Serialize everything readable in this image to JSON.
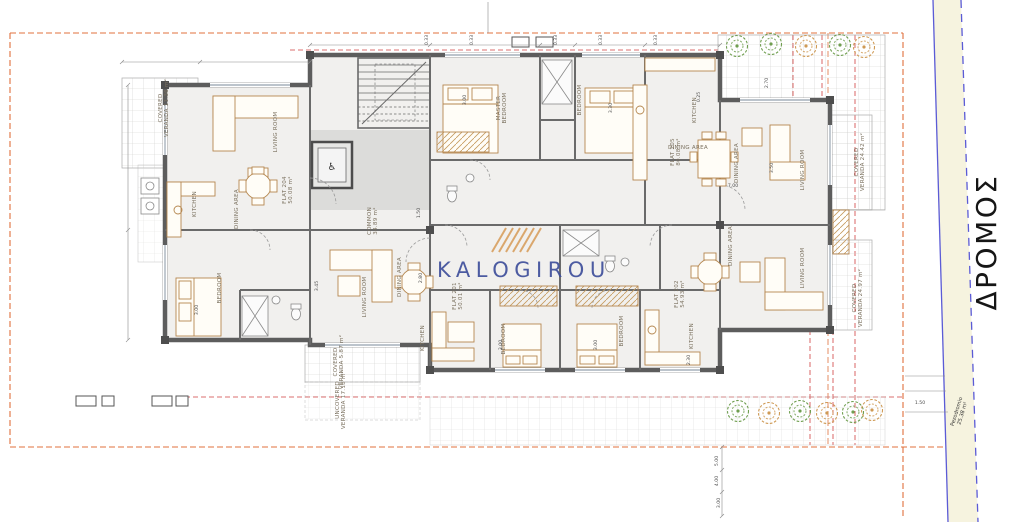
{
  "plan": {
    "watermark": {
      "text": "KALOGIROU"
    },
    "road": {
      "name": "ΔΡΟΜΟΣ",
      "sidewalk_name": "Pezodromio",
      "sidewalk_area": "25.38 m²"
    },
    "icons": {
      "wheelchair": "♿"
    },
    "colors": {
      "watermark": "#3f4f9b",
      "road_line": "#5b5bd6",
      "road_fill": "#f6f3df",
      "boundary": "#e0703d",
      "setback": "#cf4040",
      "wall": "#5d5d5d",
      "furniture": "#b5874f",
      "tree_green": "#6f9e4f",
      "tree_tan": "#cf9a55"
    },
    "room_labels": [
      {
        "text": "COVERED",
        "area": "VERANDA 11.36 m²",
        "x": 162,
        "y": 108,
        "rot": -90
      },
      {
        "text": "LIVING ROOM",
        "x": 277,
        "y": 132,
        "rot": -90
      },
      {
        "text": "KITCHEN",
        "x": 196,
        "y": 204,
        "rot": -90
      },
      {
        "text": "DINING AREA",
        "x": 238,
        "y": 209,
        "rot": -90
      },
      {
        "text": "FLAT 204",
        "area": "50.08 m²",
        "x": 286,
        "y": 190,
        "rot": -90
      },
      {
        "text": "BEDROOM",
        "x": 221,
        "y": 288,
        "rot": -90
      },
      {
        "text": "MASTER",
        "area": "BEDROOM",
        "x": 500,
        "y": 108,
        "rot": -90
      },
      {
        "text": "BEDROOM",
        "x": 581,
        "y": 100,
        "rot": -90
      },
      {
        "text": "KITCHEN",
        "x": 696,
        "y": 110,
        "rot": -90
      },
      {
        "text": "DINING AREA",
        "x": 688,
        "y": 149,
        "rot": 0
      },
      {
        "text": "FLAT 205",
        "area": "80.08 m²",
        "x": 674,
        "y": 152,
        "rot": -90
      },
      {
        "text": "DINING AREA",
        "x": 738,
        "y": 163,
        "rot": -90
      },
      {
        "text": "LIVING ROOM",
        "x": 804,
        "y": 170,
        "rot": -90
      },
      {
        "text": "COVERED",
        "area": "VERANDA 24.42 m²",
        "x": 858,
        "y": 162,
        "rot": -90
      },
      {
        "text": "DINING AREA",
        "x": 732,
        "y": 246,
        "rot": -90
      },
      {
        "text": "LIVING ROOM",
        "x": 804,
        "y": 268,
        "rot": -90
      },
      {
        "text": "COVERED",
        "area": "VERANDA 24.97 m²",
        "x": 856,
        "y": 298,
        "rot": -90
      },
      {
        "text": "COMMON",
        "area": "34.89 m²",
        "x": 371,
        "y": 221,
        "rot": -90
      },
      {
        "text": "LIVING ROOM",
        "x": 366,
        "y": 297,
        "rot": -90
      },
      {
        "text": "DINING AREA",
        "x": 401,
        "y": 277,
        "rot": -90
      },
      {
        "text": "FLAT 201",
        "area": "50.01 m²",
        "x": 456,
        "y": 296,
        "rot": -90
      },
      {
        "text": "KITCHEN",
        "x": 424,
        "y": 338,
        "rot": -90
      },
      {
        "text": "BEDROOM",
        "x": 505,
        "y": 339,
        "rot": -90
      },
      {
        "text": "BEDROOM",
        "x": 623,
        "y": 331,
        "rot": -90
      },
      {
        "text": "FLAT 202",
        "area": "54.93 m²",
        "x": 678,
        "y": 294,
        "rot": -90
      },
      {
        "text": "KITCHEN",
        "x": 693,
        "y": 336,
        "rot": -90
      },
      {
        "text": "COVERED",
        "area": "VERANDA 5.87 m²",
        "x": 337,
        "y": 362,
        "rot": -90
      },
      {
        "text": "UNCOVERED",
        "area": "VERANDA 17.18 m²",
        "x": 339,
        "y": 400,
        "rot": -90
      }
    ],
    "dim_labels": [
      {
        "text": "0.33",
        "x": 428,
        "y": 40,
        "rot": -90
      },
      {
        "text": "0.33",
        "x": 473,
        "y": 40,
        "rot": -90
      },
      {
        "text": "0.33",
        "x": 557,
        "y": 40,
        "rot": -90
      },
      {
        "text": "0.33",
        "x": 602,
        "y": 40,
        "rot": -90
      },
      {
        "text": "0.33",
        "x": 657,
        "y": 40,
        "rot": -90
      },
      {
        "text": "3.00",
        "x": 466,
        "y": 100,
        "rot": -90
      },
      {
        "text": "3.30",
        "x": 612,
        "y": 108,
        "rot": -90
      },
      {
        "text": "2.70",
        "x": 768,
        "y": 83,
        "rot": -90
      },
      {
        "text": "3.50",
        "x": 773,
        "y": 168,
        "rot": -90
      },
      {
        "text": "7.00",
        "x": 733,
        "y": 187,
        "rot": 0
      },
      {
        "text": "2.80",
        "x": 422,
        "y": 278,
        "rot": -90
      },
      {
        "text": "3.45",
        "x": 318,
        "y": 286,
        "rot": -90
      },
      {
        "text": "3.00",
        "x": 198,
        "y": 310,
        "rot": -90
      },
      {
        "text": "3.00",
        "x": 502,
        "y": 345,
        "rot": -90
      },
      {
        "text": "3.00",
        "x": 597,
        "y": 345,
        "rot": -90
      },
      {
        "text": "1.50",
        "x": 420,
        "y": 213,
        "rot": -90
      },
      {
        "text": "0.25",
        "x": 700,
        "y": 97,
        "rot": -90
      },
      {
        "text": "2.30",
        "x": 690,
        "y": 360,
        "rot": -90
      },
      {
        "text": "5.00",
        "x": 718,
        "y": 461,
        "rot": -90
      },
      {
        "text": "4.00",
        "x": 718,
        "y": 481,
        "rot": -90
      },
      {
        "text": "3.00",
        "x": 720,
        "y": 503,
        "rot": -90
      },
      {
        "text": "1.50",
        "x": 920,
        "y": 404,
        "rot": 0
      }
    ],
    "trees": [
      {
        "x": 737,
        "y": 46,
        "type": "green"
      },
      {
        "x": 771,
        "y": 44,
        "type": "green"
      },
      {
        "x": 806,
        "y": 46,
        "type": "tan"
      },
      {
        "x": 840,
        "y": 45,
        "type": "green"
      },
      {
        "x": 864,
        "y": 47,
        "type": "tan"
      },
      {
        "x": 738,
        "y": 411,
        "type": "green"
      },
      {
        "x": 769,
        "y": 413,
        "type": "tan"
      },
      {
        "x": 800,
        "y": 411,
        "type": "green"
      },
      {
        "x": 827,
        "y": 413,
        "type": "tan"
      },
      {
        "x": 853,
        "y": 412,
        "type": "green"
      },
      {
        "x": 872,
        "y": 410,
        "type": "tan"
      }
    ]
  }
}
